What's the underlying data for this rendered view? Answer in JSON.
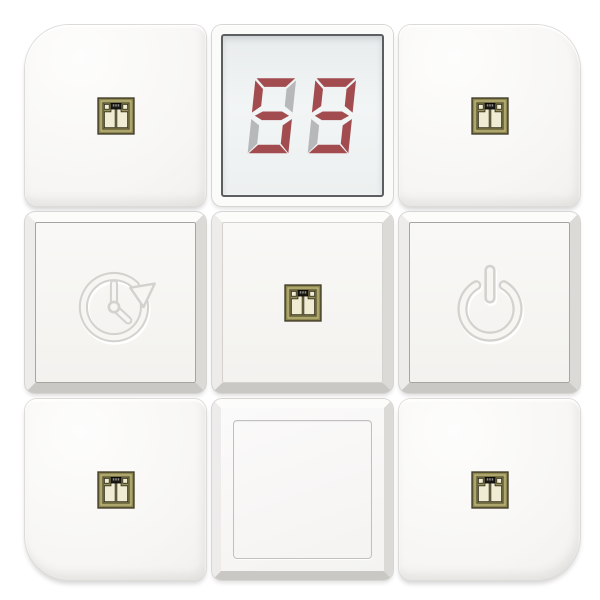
{
  "panel": {
    "name": "white-switch-keypad",
    "grid": "3x3"
  },
  "display": {
    "value": "59",
    "digits": [
      {
        "char": "5",
        "on": [
          "a",
          "f",
          "g",
          "c",
          "d"
        ],
        "off": [
          "b",
          "e"
        ]
      },
      {
        "char": "9",
        "on": [
          "a",
          "b",
          "f",
          "g",
          "c",
          "d"
        ],
        "off": [
          "e"
        ]
      }
    ]
  },
  "buttons": [
    {
      "id": "top-left",
      "icon": "gold-module-icon"
    },
    {
      "id": "top-center",
      "icon": "seven-segment-display"
    },
    {
      "id": "top-right",
      "icon": "gold-module-icon"
    },
    {
      "id": "middle-left",
      "icon": "timer-clock-icon"
    },
    {
      "id": "middle-center",
      "icon": "gold-module-icon"
    },
    {
      "id": "middle-right",
      "icon": "power-icon"
    },
    {
      "id": "bottom-left",
      "icon": "gold-module-icon"
    },
    {
      "id": "bottom-center",
      "icon": "blank"
    },
    {
      "id": "bottom-right",
      "icon": "gold-module-icon"
    }
  ],
  "colors": {
    "segment_on": "#a24c50",
    "segment_off": "#b6b8ba",
    "lcd_border": "#5c5f62",
    "icon_gold": "#8e8750",
    "icon_gold_dark": "#44402a",
    "icon_cream": "#f0ecd4",
    "emboss_line": "#d3d2ce",
    "button_face": "#f7f6f3"
  }
}
